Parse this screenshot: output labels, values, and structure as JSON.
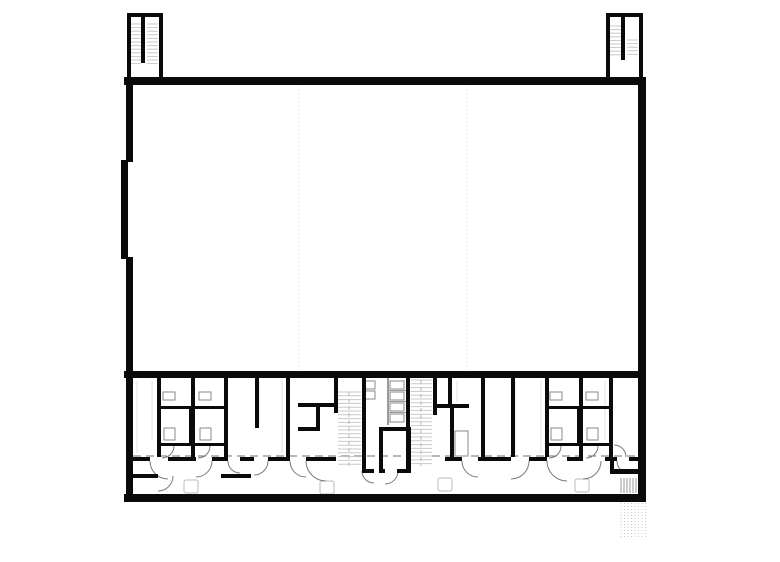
{
  "page": {
    "width": 780,
    "height": 562,
    "background": "#ffffff",
    "kind": "architectural-floor-plan"
  },
  "palette": {
    "wall": "#0a0a0a",
    "tread": "#c8c8c8",
    "guide": "#d9d9d9",
    "arc": "#7a7a7a",
    "fixture": "#8a8a8a",
    "light": "#e2e2e2",
    "dash": "#6f6f6f",
    "thin": "#9a9a9a",
    "hatch": "#9a9a9a",
    "hatch_light": "#c9c9c9",
    "centerline": "#bbbbbb"
  },
  "plan": {
    "walls": [
      [
        127,
        13,
        36,
        4
      ],
      [
        127,
        13,
        4,
        68
      ],
      [
        159,
        13,
        4,
        68
      ],
      [
        141,
        13,
        4,
        50
      ],
      [
        606,
        13,
        37,
        4
      ],
      [
        606,
        13,
        4,
        66
      ],
      [
        639,
        13,
        4,
        66
      ],
      [
        621,
        13,
        4,
        47
      ],
      [
        124,
        77,
        522,
        8
      ],
      [
        126,
        85,
        7,
        77
      ],
      [
        121,
        160,
        7,
        99
      ],
      [
        126,
        257,
        7,
        245
      ],
      [
        638,
        85,
        8,
        417
      ],
      [
        124,
        371,
        522,
        7
      ],
      [
        124,
        494,
        522,
        8
      ],
      [
        157,
        378,
        4,
        79
      ],
      [
        191,
        378,
        4,
        79
      ],
      [
        224,
        378,
        4,
        79
      ],
      [
        255,
        378,
        4,
        50
      ],
      [
        286,
        378,
        4,
        79
      ],
      [
        334,
        378,
        4,
        35
      ],
      [
        362,
        378,
        4,
        95
      ],
      [
        406,
        378,
        4,
        95
      ],
      [
        433,
        378,
        4,
        37
      ],
      [
        448,
        378,
        4,
        28
      ],
      [
        450,
        408,
        4,
        49
      ],
      [
        481,
        378,
        4,
        79
      ],
      [
        511,
        378,
        4,
        79
      ],
      [
        545,
        378,
        4,
        79
      ],
      [
        579,
        378,
        4,
        79
      ],
      [
        609,
        378,
        4,
        79
      ],
      [
        157,
        406,
        71,
        3
      ],
      [
        157,
        443,
        71,
        3
      ],
      [
        189,
        406,
        4,
        40
      ],
      [
        545,
        406,
        68,
        3
      ],
      [
        545,
        443,
        68,
        3
      ],
      [
        577,
        406,
        4,
        40
      ],
      [
        298,
        403,
        40,
        4
      ],
      [
        316,
        407,
        4,
        22
      ],
      [
        298,
        427,
        22,
        4
      ],
      [
        433,
        404,
        36,
        4
      ],
      [
        379,
        427,
        32,
        4
      ],
      [
        379,
        427,
        4,
        46
      ],
      [
        407,
        427,
        4,
        46
      ],
      [
        379,
        469,
        6,
        4
      ],
      [
        397,
        469,
        14,
        4
      ],
      [
        362,
        469,
        12,
        4
      ],
      [
        128,
        474,
        30,
        4
      ],
      [
        221,
        474,
        30,
        4
      ],
      [
        610,
        469,
        28,
        5
      ],
      [
        610,
        459,
        4,
        12
      ]
    ],
    "corridor_wall_segments": [
      [
        133,
        457,
        17,
        4
      ],
      [
        168,
        457,
        28,
        4
      ],
      [
        212,
        457,
        16,
        4
      ],
      [
        240,
        457,
        14,
        4
      ],
      [
        268,
        457,
        22,
        4
      ],
      [
        306,
        457,
        30,
        4
      ],
      [
        445,
        457,
        17,
        4
      ],
      [
        478,
        457,
        33,
        4
      ],
      [
        529,
        457,
        18,
        4
      ],
      [
        567,
        457,
        16,
        4
      ],
      [
        605,
        457,
        12,
        4
      ],
      [
        629,
        457,
        9,
        4
      ]
    ],
    "thin_partitions": [
      [
        388,
        390,
        18,
        1
      ],
      [
        388,
        401,
        18,
        1
      ],
      [
        388,
        412,
        18,
        1
      ],
      [
        387,
        378,
        2,
        47
      ]
    ],
    "guides": [
      {
        "x": 299,
        "y1": 85,
        "y2": 371
      },
      {
        "x": 467,
        "y1": 85,
        "y2": 371
      }
    ],
    "corridor_dash": {
      "y": 456,
      "x1": 133,
      "x2": 637
    },
    "stair_treads": [
      {
        "x1": 131,
        "x2": 141,
        "y1": 24,
        "y2": 64,
        "step": 3.6
      },
      {
        "x1": 147,
        "x2": 158,
        "y1": 24,
        "y2": 64,
        "step": 3.6
      },
      {
        "x1": 610,
        "x2": 621,
        "y1": 26,
        "y2": 58,
        "step": 3.6
      },
      {
        "x1": 627,
        "x2": 638,
        "y1": 40,
        "y2": 58,
        "step": 3.6
      },
      {
        "x1": 338,
        "x2": 361,
        "y1": 392,
        "y2": 468,
        "step": 3.8
      },
      {
        "x1": 411,
        "x2": 432,
        "y1": 380,
        "y2": 466,
        "step": 3.8
      }
    ],
    "stair_centerlines": [
      [
        349,
        392,
        349,
        468
      ],
      [
        421,
        380,
        421,
        466
      ]
    ],
    "door_arcs": [
      {
        "cx": 168,
        "cy": 461,
        "r": 18,
        "a0": 180,
        "a1": 90
      },
      {
        "cx": 196,
        "cy": 461,
        "r": 16,
        "a0": 0,
        "a1": 90
      },
      {
        "cx": 240,
        "cy": 461,
        "r": 12,
        "a0": 180,
        "a1": 90
      },
      {
        "cx": 254,
        "cy": 461,
        "r": 14,
        "a0": 0,
        "a1": 90
      },
      {
        "cx": 306,
        "cy": 461,
        "r": 16,
        "a0": 180,
        "a1": 90
      },
      {
        "cx": 326,
        "cy": 461,
        "r": 20,
        "a0": 180,
        "a1": 90
      },
      {
        "cx": 478,
        "cy": 461,
        "r": 16,
        "a0": 180,
        "a1": 90
      },
      {
        "cx": 511,
        "cy": 461,
        "r": 18,
        "a0": 0,
        "a1": 90
      },
      {
        "cx": 567,
        "cy": 461,
        "r": 20,
        "a0": 180,
        "a1": 90
      },
      {
        "cx": 583,
        "cy": 461,
        "r": 18,
        "a0": 0,
        "a1": 90
      },
      {
        "cx": 629,
        "cy": 461,
        "r": 12,
        "a0": 180,
        "a1": 90
      },
      {
        "cx": 162,
        "cy": 446,
        "r": 12,
        "a0": 0,
        "a1": 90
      },
      {
        "cx": 198,
        "cy": 446,
        "r": 12,
        "a0": 0,
        "a1": 90
      },
      {
        "cx": 549,
        "cy": 446,
        "r": 12,
        "a0": 0,
        "a1": 90
      },
      {
        "cx": 586,
        "cy": 446,
        "r": 12,
        "a0": 0,
        "a1": 90
      },
      {
        "cx": 385,
        "cy": 471,
        "r": 13,
        "a0": 0,
        "a1": 90
      },
      {
        "cx": 374,
        "cy": 471,
        "r": 12,
        "a0": 180,
        "a1": 90
      },
      {
        "cx": 158,
        "cy": 476,
        "r": 15,
        "a0": 0,
        "a1": 90
      },
      {
        "cx": 614,
        "cy": 457,
        "r": 12,
        "a0": -90,
        "a1": 0
      }
    ],
    "fixtures": [
      [
        363,
        381,
        12,
        8
      ],
      [
        363,
        391,
        12,
        8
      ],
      [
        390,
        381,
        14,
        8
      ],
      [
        390,
        392,
        14,
        8
      ],
      [
        390,
        403,
        14,
        8
      ],
      [
        390,
        414,
        14,
        8
      ],
      [
        163,
        392,
        12,
        8
      ],
      [
        199,
        392,
        12,
        8
      ],
      [
        550,
        392,
        12,
        8
      ],
      [
        586,
        392,
        12,
        8
      ],
      [
        164,
        428,
        11,
        12
      ],
      [
        200,
        428,
        11,
        12
      ],
      [
        551,
        428,
        11,
        12
      ],
      [
        587,
        428,
        11,
        12
      ],
      [
        455,
        431,
        13,
        25
      ]
    ],
    "light_squares": [
      [
        184,
        480,
        14,
        13
      ],
      [
        320,
        481,
        14,
        13
      ],
      [
        438,
        478,
        14,
        13
      ],
      [
        575,
        479,
        14,
        13
      ]
    ],
    "hatches": [
      {
        "x": 621,
        "y": 478,
        "w": 16,
        "h": 15,
        "step": 3,
        "style": "solid"
      },
      {
        "x": 621,
        "y": 503,
        "w": 26,
        "h": 34,
        "step": 3.5,
        "style": "dotted"
      }
    ],
    "texture_lines": [
      [
        137,
        381,
        137,
        453
      ],
      [
        152,
        381,
        152,
        440
      ],
      [
        259,
        381,
        259,
        425
      ],
      [
        282,
        381,
        282,
        453
      ],
      [
        457,
        381,
        457,
        402
      ],
      [
        515,
        381,
        515,
        453
      ],
      [
        541,
        381,
        541,
        453
      ],
      [
        605,
        381,
        605,
        440
      ]
    ]
  }
}
